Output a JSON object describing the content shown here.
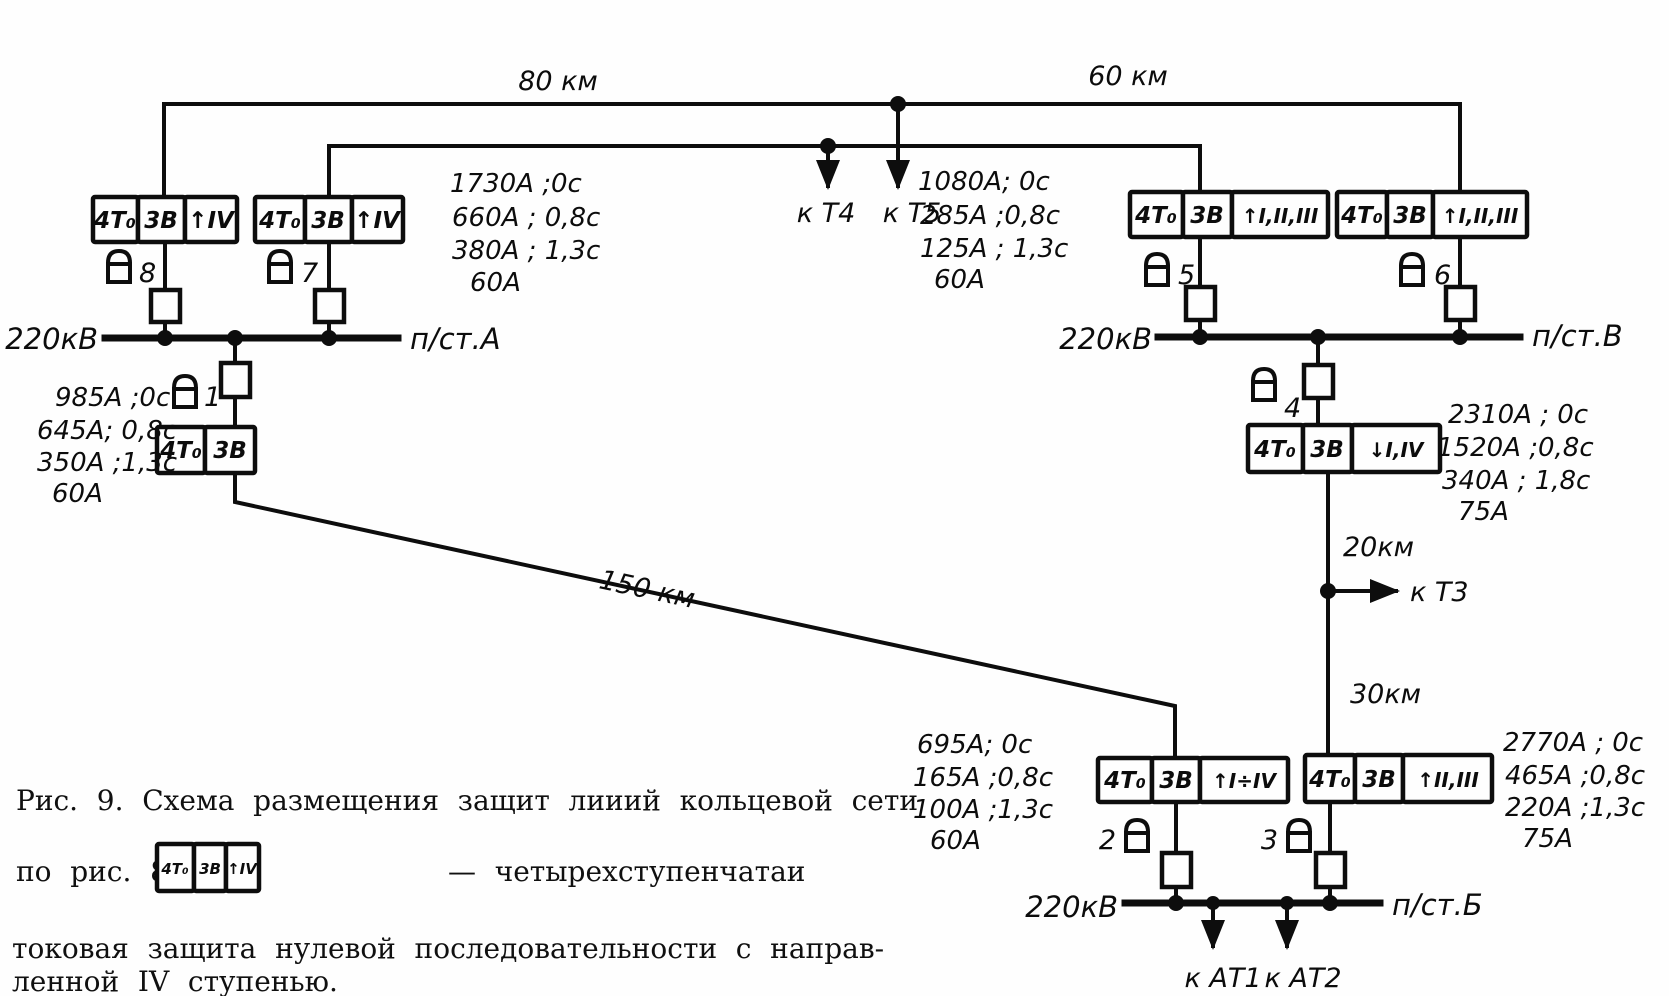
{
  "figure_caption": {
    "line1": "Рис. 9. Схема размещения защит лииий кольцевой сети",
    "line2": "по рис. 8,а.",
    "legend_cells": [
      "4Т₀",
      "3В",
      "↑IV"
    ],
    "legend_description": "— четырехступенчатаи",
    "line3": "токовая защита нулевой последовательности с направ-",
    "line4": "ленной IV ступенью."
  },
  "stations": {
    "a": {
      "voltage": "220кВ",
      "name": "п/ст.А"
    },
    "v": {
      "voltage": "220кВ",
      "name": "п/ст.В"
    },
    "b": {
      "voltage": "220кВ",
      "name": "п/ст.Б"
    }
  },
  "line_labels": {
    "l80": "80 км",
    "l60": "60 км",
    "l150": "150 км",
    "l20": "20км",
    "l30": "30км"
  },
  "tap_labels": {
    "t4": "к Т4",
    "t5": "к Т5",
    "t3": "к Т3",
    "at1": "к АТ1",
    "at2": "к АТ2"
  },
  "relays": {
    "r1": {
      "number": "1",
      "cells": [
        "4Т₀",
        "3В"
      ]
    },
    "r2": {
      "number": "2",
      "cells": [
        "4Т₀",
        "3В",
        "↑I÷IV"
      ]
    },
    "r3": {
      "number": "3",
      "cells": [
        "4Т₀",
        "3В",
        "↑II,III"
      ]
    },
    "r4": {
      "number": "4",
      "cells": [
        "4Т₀",
        "3В",
        "↓I,IV"
      ]
    },
    "r5": {
      "number": "5",
      "cells": [
        "4Т₀",
        "3В",
        "↑I,II,III"
      ]
    },
    "r6": {
      "number": "6",
      "cells": [
        "4Т₀",
        "3В",
        "↑I,II,III"
      ]
    },
    "r7": {
      "number": "7",
      "cells": [
        "4Т₀",
        "3В",
        "↑IV"
      ]
    },
    "r8": {
      "number": "8",
      "cells": [
        "4Т₀",
        "3В",
        "↑IV"
      ]
    }
  },
  "settings": {
    "r7_block": [
      "1730А ;0с",
      "660А ; 0,8с",
      "380А ; 1,3с",
      "60А"
    ],
    "r5_block": [
      "1080А; 0с",
      "285А ;0,8с",
      "125А ; 1,3с",
      "60А"
    ],
    "r1_block": [
      "985А ;0с",
      "645А; 0,8с",
      "350А ;1,3с",
      "60А"
    ],
    "r4_block": [
      "2310А ; 0с",
      "1520А ;0,8с",
      "340А ; 1,8с",
      "75А"
    ],
    "r2_block": [
      "695А; 0с",
      "165А ;0,8с",
      "100А ;1,3с",
      "60А"
    ],
    "r3_block": [
      "2770А ; 0с",
      "465А ;0,8с",
      "220А ;1,3с",
      "75А"
    ]
  }
}
